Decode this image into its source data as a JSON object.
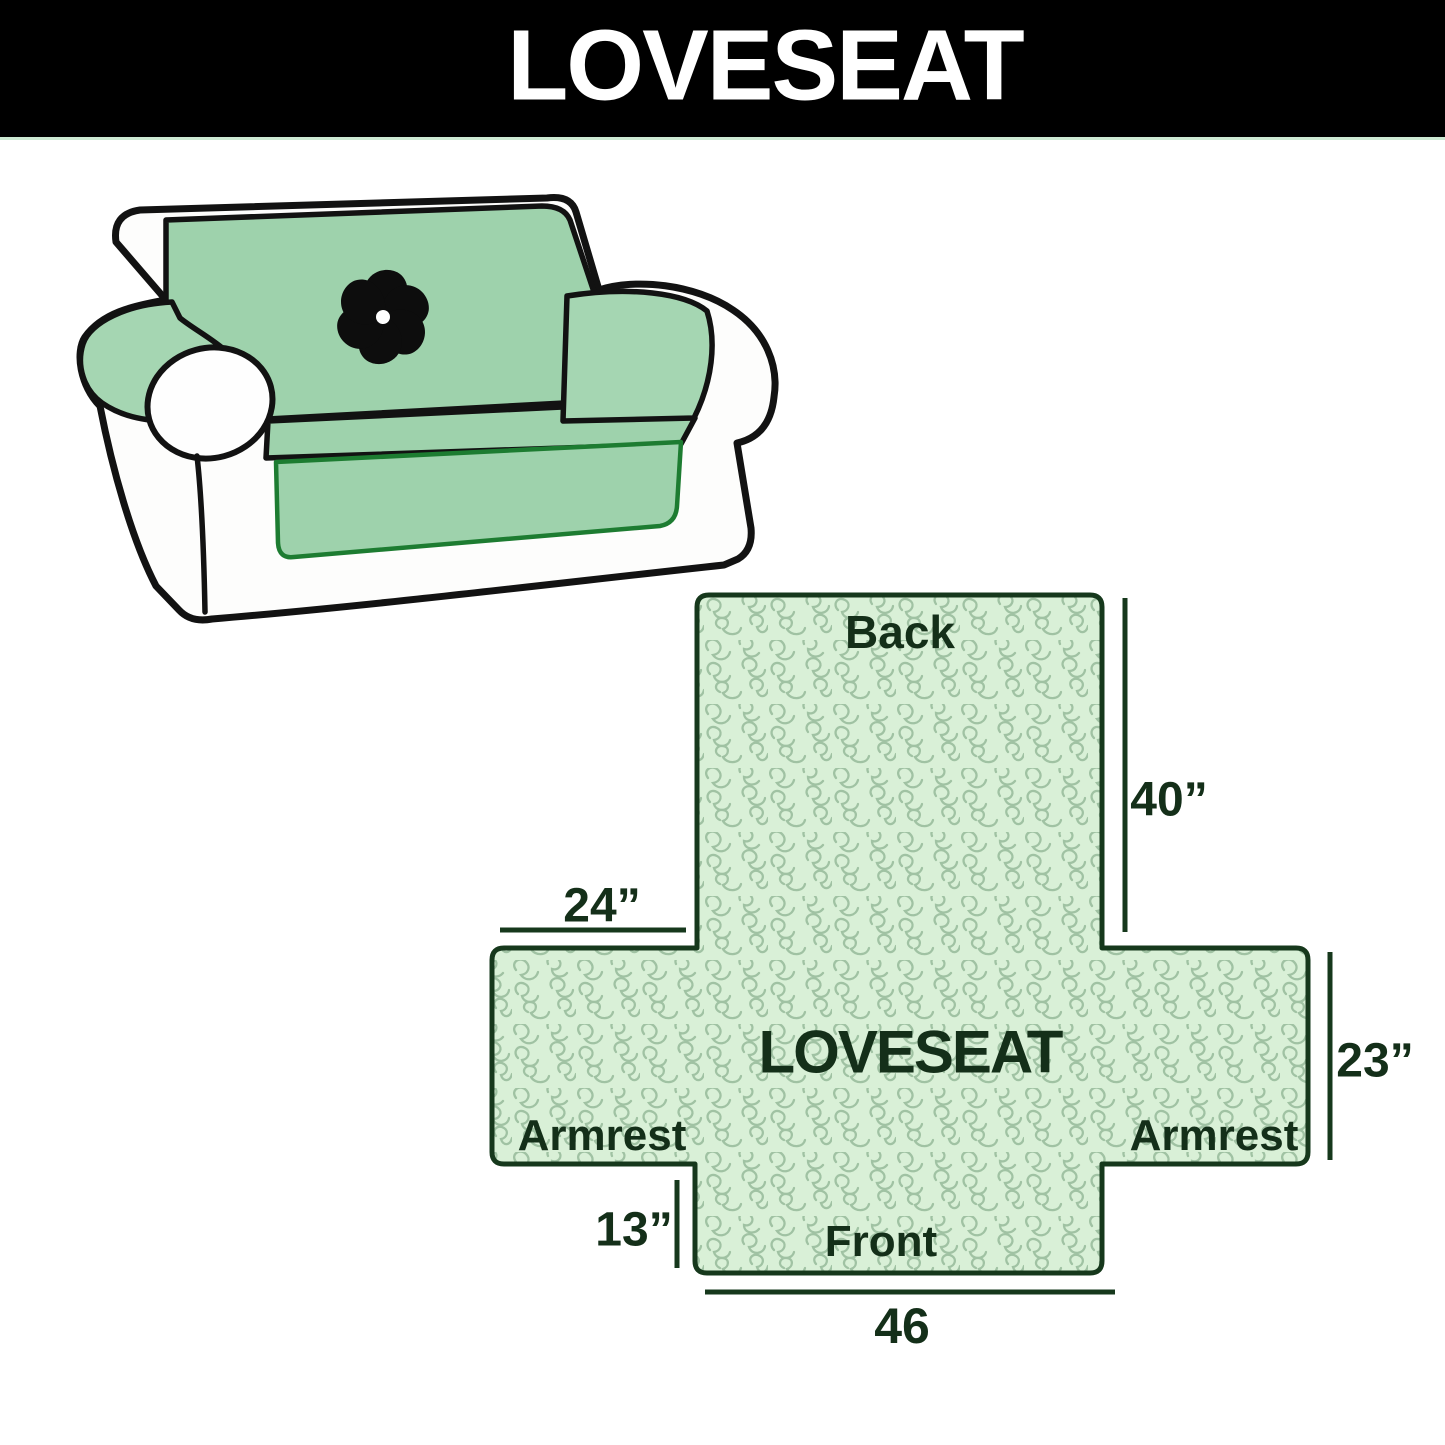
{
  "header": {
    "title": "LOVESEAT"
  },
  "sofa": {
    "logo_icon": "pinwheel-fan-logo"
  },
  "diagram": {
    "labels": {
      "back": "Back",
      "center": "LOVESEAT",
      "armrest_left": "Armrest",
      "armrest_right": "Armrest",
      "front": "Front"
    },
    "dimensions": {
      "back_height": "40”",
      "armrest_top_width": "24”",
      "side_depth": "23”",
      "front_drop_height": "13”",
      "front_width": "46"
    }
  },
  "colors": {
    "header_bg": "#000000",
    "header_text": "#ffffff",
    "outline": "#16381c",
    "text": "#142f19",
    "pattern_bg": "#d9f0d7",
    "pattern_line": "#a0c2a3",
    "cover_green": "#9ed2ac",
    "cover_green_lt": "#a5d6b2",
    "accent_green": "#1d7c31",
    "sofa_line": "#121212",
    "logo_black": "#0d0d0d"
  }
}
